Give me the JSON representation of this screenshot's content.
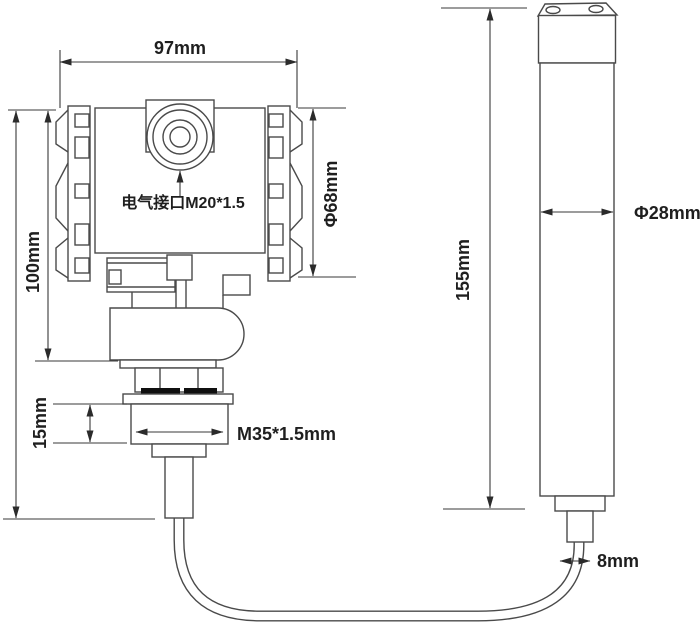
{
  "drawing": {
    "head": {
      "width_label": "97mm",
      "height_label": "100mm",
      "diameter_label": "Φ68mm",
      "electrical_port_label": "电气接口M20*1.5",
      "mount_thread_height_label": "15mm",
      "mount_thread_label": "M35*1.5mm"
    },
    "probe": {
      "length_label": "155mm",
      "diameter_label": "Φ28mm",
      "cable_diameter_label": "8mm"
    },
    "colors": {
      "line": "#4a4a4a",
      "text": "#1f1f1f",
      "background": "#ffffff"
    }
  }
}
